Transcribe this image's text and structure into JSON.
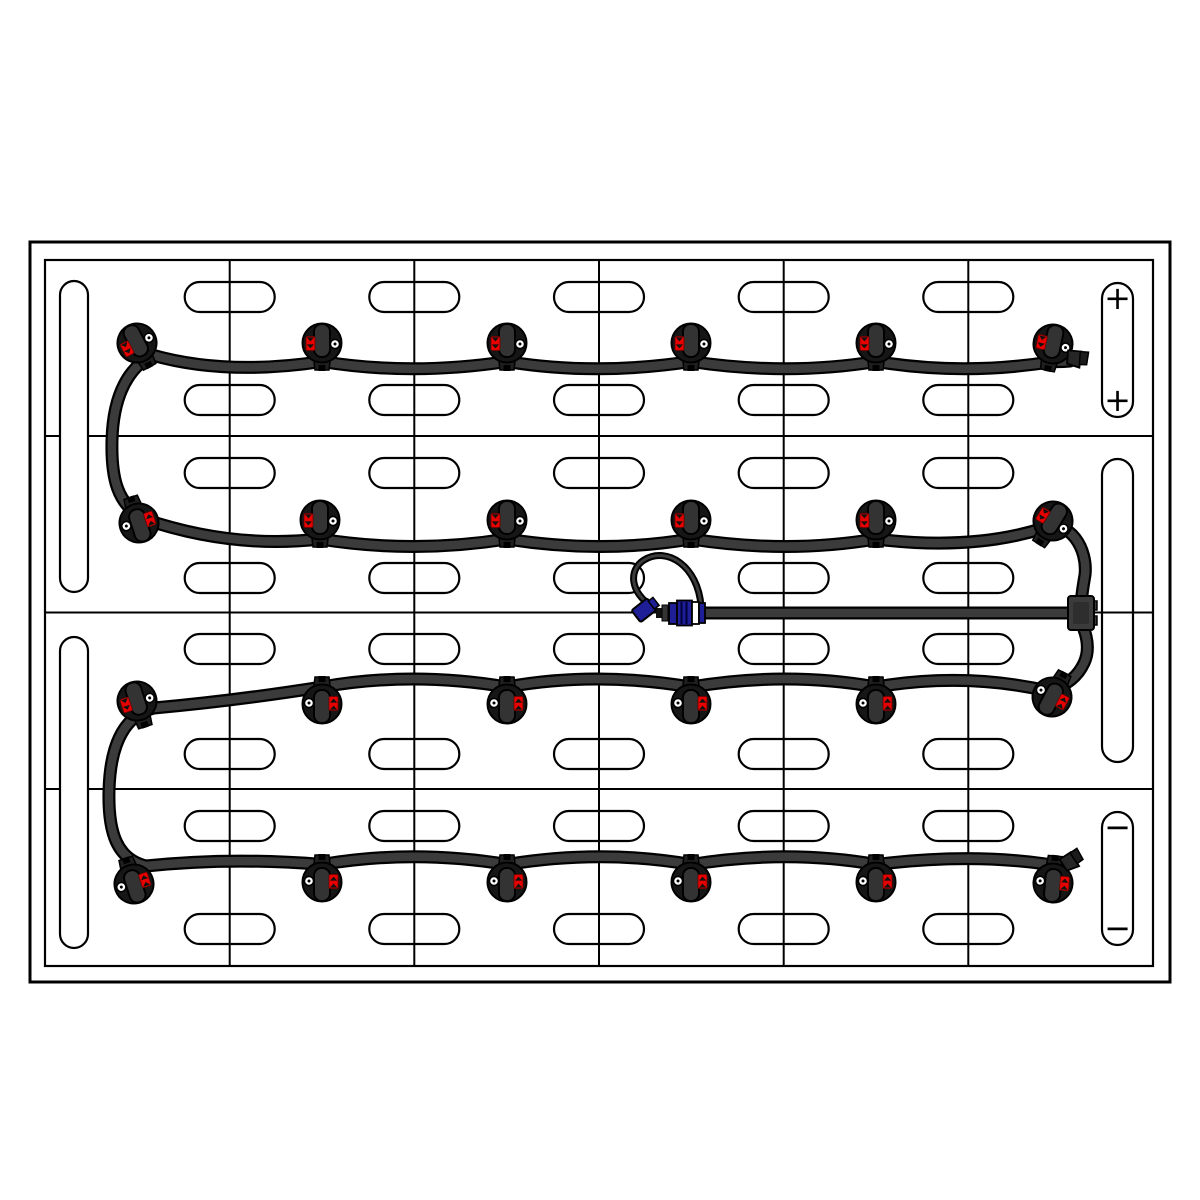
{
  "diagram": {
    "kind": "battery-watering-system-top-view",
    "colors": {
      "background": "#ffffff",
      "line": "#000000",
      "tube_outline": "#000000",
      "tube_fill": "#3b3b3b",
      "cap_body": "#161616",
      "cap_lever": "#333333",
      "red_indicator": "#e80000",
      "indicator_dark": "#111111",
      "coupler_blue": "#1e1e96",
      "white": "#ffffff"
    },
    "tray": {
      "outer": {
        "x": 30,
        "y": 242,
        "w": 1140,
        "h": 740,
        "stroke_w": 3
      },
      "inner": {
        "x": 45,
        "y": 260,
        "w": 1108,
        "h": 706,
        "stroke_w": 2.2
      }
    },
    "grid": {
      "rows": 4,
      "cols": 6,
      "col_lines_x": [
        229.7,
        414.3,
        599,
        783.7,
        968.3
      ],
      "row_lines_y": [
        436,
        612.5,
        789
      ],
      "top": 260,
      "bottom": 966,
      "left": 45,
      "right": 1153,
      "mid_line_overlay": {
        "x1": 1094,
        "y1": 612.5,
        "x2": 1153,
        "y2": 612.5
      }
    },
    "vent_slots": {
      "band_centers_y": [
        297,
        400,
        473,
        578,
        649,
        754,
        826,
        929
      ],
      "centers_x": [
        229.7,
        414.3,
        599,
        783.7,
        968.3
      ],
      "w": 90,
      "h": 30,
      "rx": 15
    },
    "side_slots": {
      "left": [
        {
          "x": 60,
          "y": 281,
          "w": 28,
          "h": 311,
          "rx": 14
        },
        {
          "x": 60,
          "y": 637,
          "w": 28,
          "h": 311,
          "rx": 14
        }
      ],
      "right": [
        {
          "x": 1102,
          "y": 283,
          "w": 31,
          "h": 134,
          "rx": 15.5
        },
        {
          "x": 1102,
          "y": 459,
          "w": 31,
          "h": 303,
          "rx": 15.5
        },
        {
          "x": 1102,
          "y": 812,
          "w": 31,
          "h": 133,
          "rx": 15.5
        }
      ]
    },
    "terminal_marks": [
      {
        "x": 1117.5,
        "y": 298,
        "symbol": "+",
        "name": "positive-terminal-mark"
      },
      {
        "x": 1117.5,
        "y": 400,
        "symbol": "+",
        "name": "positive-terminal-mark"
      },
      {
        "x": 1117.5,
        "y": 827,
        "symbol": "−",
        "name": "negative-terminal-mark"
      },
      {
        "x": 1117.5,
        "y": 928,
        "symbol": "−",
        "name": "negative-terminal-mark"
      }
    ],
    "tubes": {
      "main_w_outer": 13,
      "main_w_inner": 8.5,
      "tether_w_outer": 7,
      "tether_w_inner": 3,
      "upper_run": "M 1070,361 Q 1060,362 1053,361.5 Q 964,376 876,361.5 Q 787,376 691,361.5 Q 595,376 507,361.5 Q 411,376 322,361.5 Q 226,376 152,355 C 124,371 113,402 112,440 C 111,478 117,504 144,519 Q 232,549 320,539 Q 413,554 507,539 Q 601,554 691,539 Q 787,554 876,539 Q 972,551 1044,528 C 1070,519 1088,549 1085,575 Q 1082,592 1081,604",
      "lower_run": "M 1081,622 Q 1092,646 1084,663 C 1078,676 1068,685 1048,691 Q 964,672 876,687 Q 787,671 691,687 Q 595,671 507,687 Q 411,671 322,687 Q 233,701 154,708 C 122,716 110,748 109,791 C 108,833 117,859 146,866 Q 232,857 322,864.5 Q 413,849 507,864.5 Q 601,849 691,864.5 Q 787,849 876,864.5 Q 968,853 1046,864",
      "feed_line": "M 706,613 L 1069,613",
      "tether_loop": "M 701,606 C 698,566 667,546 644,560 C 628,570 630,593 653,607"
    },
    "tee_fitting": {
      "x": 1068,
      "y": 596,
      "w": 26,
      "h": 34,
      "rx": 3,
      "tabs": [
        {
          "x": 1090,
          "y": 601,
          "w": 7,
          "h": 9
        },
        {
          "x": 1090,
          "y": 616,
          "w": 7,
          "h": 9
        }
      ]
    },
    "coupler": {
      "dust_cap": {
        "cx": 645,
        "cy": 610,
        "rot": -38
      },
      "parts": [
        {
          "x": 656,
          "y": 608,
          "w": 6,
          "h": 10,
          "fill": "indicator_dark",
          "sw": 0
        },
        {
          "x": 662,
          "y": 605,
          "w": 6,
          "h": 16,
          "fill": "cap_lever",
          "sw": 1
        },
        {
          "x": 669,
          "y": 603,
          "w": 8,
          "h": 21,
          "fill": "coupler_blue",
          "sw": 1.8
        },
        {
          "x": 677,
          "y": 600.5,
          "w": 15,
          "h": 25,
          "fill": "coupler_blue",
          "sw": 1.8
        },
        {
          "x": 692,
          "y": 602,
          "w": 7,
          "h": 22,
          "fill": "white",
          "sw": 1.8
        },
        {
          "x": 699,
          "y": 603,
          "w": 6,
          "h": 20,
          "fill": "coupler_blue",
          "sw": 1.8
        }
      ],
      "rib_lines_x": [
        681.5,
        686.5
      ],
      "rib_y1": 602,
      "rib_y2": 624
    },
    "caps": [
      {
        "x": 137,
        "y": 343,
        "rot": -28
      },
      {
        "x": 322,
        "y": 343,
        "rot": 0
      },
      {
        "x": 507,
        "y": 343,
        "rot": 0
      },
      {
        "x": 691,
        "y": 343,
        "rot": 0
      },
      {
        "x": 876,
        "y": 343,
        "rot": 0
      },
      {
        "x": 1053,
        "y": 344,
        "rot": 12
      },
      {
        "x": 139,
        "y": 523,
        "rot": 162
      },
      {
        "x": 320,
        "y": 520,
        "rot": 0
      },
      {
        "x": 507,
        "y": 520,
        "rot": 0
      },
      {
        "x": 691,
        "y": 520,
        "rot": 0
      },
      {
        "x": 876,
        "y": 520,
        "rot": 0
      },
      {
        "x": 1053,
        "y": 521,
        "rot": 32
      },
      {
        "x": 137,
        "y": 701,
        "rot": -18
      },
      {
        "x": 322,
        "y": 704,
        "rot": 180
      },
      {
        "x": 507,
        "y": 704,
        "rot": 180
      },
      {
        "x": 691,
        "y": 704,
        "rot": 180
      },
      {
        "x": 876,
        "y": 704,
        "rot": 180
      },
      {
        "x": 1052,
        "y": 697,
        "rot": 208
      },
      {
        "x": 134,
        "y": 884,
        "rot": 162
      },
      {
        "x": 322,
        "y": 882,
        "rot": 180
      },
      {
        "x": 507,
        "y": 882,
        "rot": 180
      },
      {
        "x": 691,
        "y": 882,
        "rot": 180
      },
      {
        "x": 876,
        "y": 882,
        "rot": 180
      },
      {
        "x": 1053,
        "y": 883,
        "rot": 185
      }
    ],
    "end_plugs": [
      {
        "x": 1066,
        "y": 357,
        "rot": 18
      },
      {
        "x": 1062,
        "y": 866,
        "rot": -20
      }
    ]
  }
}
